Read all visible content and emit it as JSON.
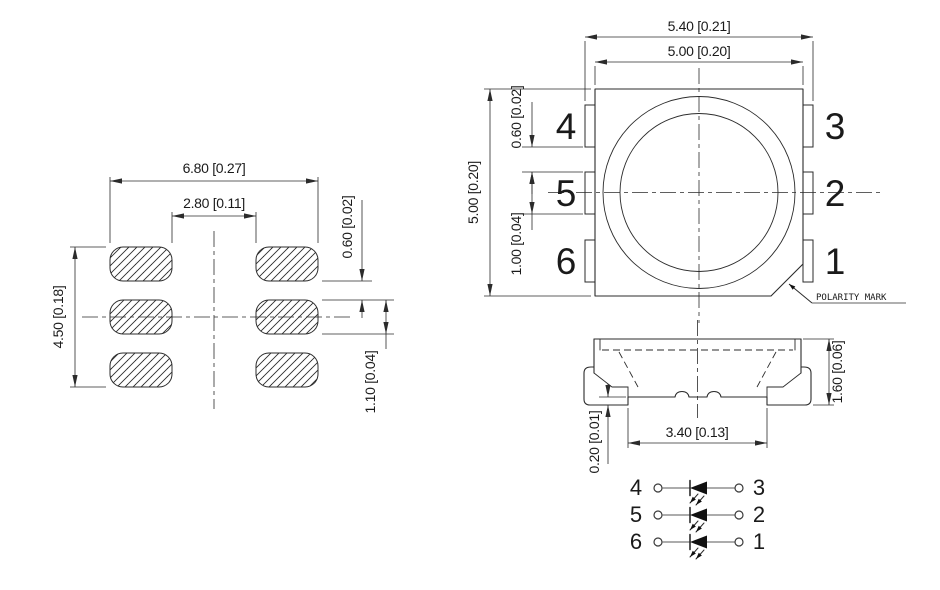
{
  "drawing": {
    "land_pattern": {
      "dim_outer_width": "6.80 [0.27]",
      "dim_inner_width": "2.80 [0.11]",
      "dim_overall_height": "4.50 [0.18]",
      "dim_pad_gap": "0.60 [0.02]",
      "dim_pad_height": "1.10 [0.04]"
    },
    "top_view": {
      "dim_overall_width": "5.40 [0.21]",
      "dim_body_width": "5.00 [0.20]",
      "dim_body_height": "5.00 [0.20]",
      "dim_lead_gap": "0.60 [0.02]",
      "dim_lead_width": "1.00 [0.04]",
      "polarity_label": "POLARITY MARK",
      "pins": {
        "p1": "1",
        "p2": "2",
        "p3": "3",
        "p4": "4",
        "p5": "5",
        "p6": "6"
      }
    },
    "side_view": {
      "dim_height": "1.60 [0.06]",
      "dim_lead_span": "3.40 [0.13]",
      "dim_standoff": "0.20 [0.01]"
    },
    "schematic": {
      "rows": [
        {
          "left": "4",
          "right": "3"
        },
        {
          "left": "5",
          "right": "2"
        },
        {
          "left": "6",
          "right": "1"
        }
      ]
    },
    "colors": {
      "line": "#2b2b2b",
      "text": "#1a1a1a",
      "background": "#ffffff"
    }
  }
}
